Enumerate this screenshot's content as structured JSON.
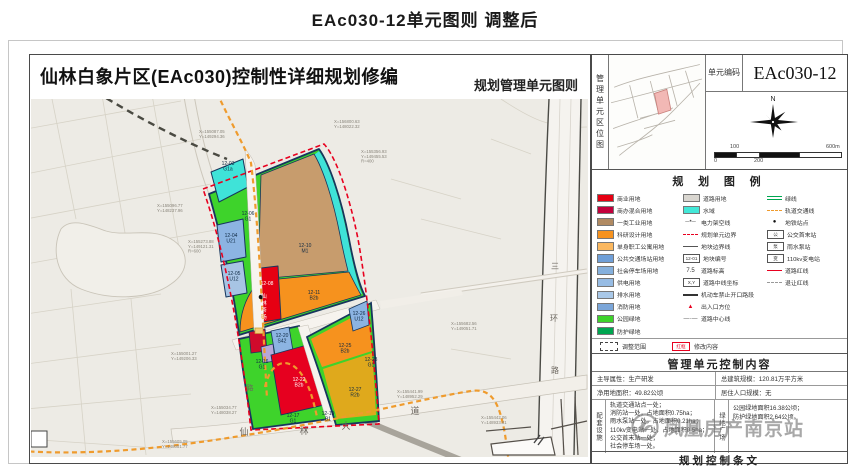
{
  "page": {
    "title": "EAc030-12单元图则 调整后"
  },
  "sheet": {
    "title": "仙林白象片区(EAc030)控制性详细规划修编",
    "subtitle": "规划管理单元图则"
  },
  "unit": {
    "code_label": "单元\n编码",
    "code": "EAc030-12"
  },
  "location": {
    "label": "管理单元区位图"
  },
  "compass": {
    "north": "N"
  },
  "scalebar": {
    "above_1": "100",
    "above_2": "600m",
    "below_1": "0",
    "below_2": "200"
  },
  "legend": {
    "title": "规 划 图 例",
    "cols": [
      [
        {
          "k": "box",
          "c": "#e60012",
          "label": "商业用地"
        },
        {
          "k": "box",
          "c": "#c2003c",
          "label": "商办混合用地"
        },
        {
          "k": "box",
          "c": "#b08a62",
          "label": "一类工业用地"
        },
        {
          "k": "box",
          "c": "#f6921e",
          "label": "科研设计用地"
        },
        {
          "k": "box",
          "c": "#fbb860",
          "label": "单身职工公寓用地"
        },
        {
          "k": "box",
          "c": "#6f9fd8",
          "label": "公共交通场站用地"
        },
        {
          "k": "box",
          "c": "#85b0dd",
          "label": "社会停车场用地"
        },
        {
          "k": "box",
          "c": "#97bce4",
          "label": "供电用地"
        },
        {
          "k": "box",
          "c": "#a9c8e8",
          "label": "排水用地"
        },
        {
          "k": "box",
          "c": "#7ba6d9",
          "label": "消防用地"
        },
        {
          "k": "box",
          "c": "#3ed32b",
          "label": "公园绿地"
        },
        {
          "k": "box",
          "c": "#00a650",
          "label": "防护绿地"
        }
      ],
      [
        {
          "k": "box",
          "c": "#d9d6d0",
          "label": "道路用地"
        },
        {
          "k": "box",
          "c": "#43e8d8",
          "label": "水域"
        },
        {
          "k": "glyph",
          "ch": "─•─",
          "c": "#555",
          "label": "电力架空线"
        },
        {
          "k": "line",
          "style": "dashed",
          "c": "#e8001f",
          "label": "规划单元边界"
        },
        {
          "k": "line",
          "style": "solid",
          "c": "#555",
          "label": "地块边界线"
        },
        {
          "k": "sym",
          "ch": "12-01",
          "label": "地块编号"
        },
        {
          "k": "glyph",
          "ch": "7.5",
          "c": "#333",
          "label": "道路标高"
        },
        {
          "k": "sym",
          "ch": "X,Y",
          "label": "道路中线坐标"
        },
        {
          "k": "line",
          "style": "thick",
          "c": "#333",
          "label": "机动车禁止开口路段"
        },
        {
          "k": "glyph",
          "ch": "▲",
          "c": "#e8001f",
          "label": "出入口方位"
        },
        {
          "k": "glyph",
          "ch": "—·—",
          "c": "#555",
          "label": "道路中心线"
        }
      ],
      [
        {
          "k": "line",
          "style": "double",
          "c": "#00a650",
          "label": "绿线"
        },
        {
          "k": "line",
          "style": "dashed",
          "c": "#ef9b2d",
          "label": "轨道交通线"
        },
        {
          "k": "glyph",
          "ch": "●",
          "c": "#111",
          "label": "地铁站点"
        },
        {
          "k": "sym",
          "ch": "公",
          "label": "公交首末站"
        },
        {
          "k": "sym",
          "ch": "泵",
          "label": "雨水泵站"
        },
        {
          "k": "sym",
          "ch": "变",
          "label": "110kv变电站"
        },
        {
          "k": "line",
          "style": "solid",
          "c": "#e8001f",
          "label": "道路红线"
        },
        {
          "k": "line",
          "style": "dashed",
          "c": "#999",
          "label": "退让红线"
        }
      ]
    ],
    "adjust_range_label": "调整范围",
    "modify_label": "修改内容",
    "modify_mark": "红框"
  },
  "content": {
    "title": "管理单元控制内容",
    "attr_r1c1": "主导属性：生产研发",
    "attr_r1c2": "总建筑规模：120.81万平方米",
    "attr_r2c1": "净用地面积：49.82公顷",
    "attr_r2c2": "居住人口规模：无",
    "facilities_header": "配套设施",
    "facilities_lines": [
      "轨道交通站点一处；",
      "消防站一处，占地面积0.75ha；",
      "雨水泵站一处，占地面积0.21ha；",
      "110kv变电站一处，占地面积0.5ha；",
      "公交首末站一处；",
      "社会停车场一处。"
    ],
    "greens_header": "绿地广场",
    "greens_lines": [
      "公园绿地面积16.38公顷；",
      "防护绿地面积2.64公顷。"
    ]
  },
  "provisions": {
    "title": "规划控制条文"
  },
  "watermark": {
    "text": "凤凰房产南京站"
  },
  "map": {
    "colors": {
      "boundary_red": "#e8001f",
      "green": "#3ed32b",
      "cyan": "#3fe3d8",
      "brown": "#c79c6d",
      "orange": "#f6921e",
      "yellow": "#dfa91c",
      "red": "#e60012",
      "blue": "#8cb4e2",
      "metro_orange": "#ef9b2d"
    },
    "parcel_labels": [
      {
        "x": 197,
        "y": 66,
        "lines": [
          "12-03",
          "G1a"
        ]
      },
      {
        "x": 200,
        "y": 138,
        "lines": [
          "12-04",
          "U21"
        ]
      },
      {
        "x": 203,
        "y": 176,
        "lines": [
          "12-05",
          "U12"
        ]
      },
      {
        "x": 217,
        "y": 116,
        "lines": [
          "12-06",
          "G1"
        ]
      },
      {
        "x": 274,
        "y": 148,
        "lines": [
          "12-10",
          "M1"
        ]
      },
      {
        "x": 283,
        "y": 195,
        "lines": [
          "12-11",
          "B2b"
        ]
      },
      {
        "x": 236,
        "y": 186,
        "lines": [
          "12-08"
        ],
        "c": "#ffffff"
      },
      {
        "x": 251,
        "y": 238,
        "lines": [
          "12-20",
          "S42"
        ]
      },
      {
        "x": 231,
        "y": 264,
        "lines": [
          "12-16",
          "G1"
        ]
      },
      {
        "x": 268,
        "y": 282,
        "lines": [
          "12-22",
          "B2b"
        ],
        "c": "#ffffff"
      },
      {
        "x": 328,
        "y": 216,
        "lines": [
          "12-26",
          "U12"
        ]
      },
      {
        "x": 314,
        "y": 248,
        "lines": [
          "12-25",
          "B2b"
        ]
      },
      {
        "x": 324,
        "y": 292,
        "lines": [
          "12-27",
          "R2b"
        ]
      },
      {
        "x": 340,
        "y": 262,
        "lines": [
          "12-28",
          "G1"
        ]
      },
      {
        "x": 262,
        "y": 318,
        "lines": [
          "12-17",
          "G1"
        ]
      },
      {
        "x": 297,
        "y": 316,
        "lines": [
          "12-19",
          "B1"
        ]
      }
    ],
    "coord_labels": [
      {
        "x": 168,
        "y": 34,
        "lines": [
          "X=155087.05",
          "Y=149294.36"
        ]
      },
      {
        "x": 303,
        "y": 24,
        "lines": [
          "X=156800.63",
          "Y=148022.32"
        ]
      },
      {
        "x": 330,
        "y": 54,
        "lines": [
          "X=155356.93",
          "Y=149455.53",
          "R=400"
        ]
      },
      {
        "x": 126,
        "y": 108,
        "lines": [
          "X=155096.77",
          "Y=148237.96"
        ]
      },
      {
        "x": 157,
        "y": 144,
        "lines": [
          "X=155273.88",
          "Y=149121.31",
          "R=600"
        ]
      },
      {
        "x": 140,
        "y": 256,
        "lines": [
          "X=155001.27",
          "Y=149206.33"
        ]
      },
      {
        "x": 180,
        "y": 310,
        "lines": [
          "X=155034.77",
          "Y=148038.27"
        ]
      },
      {
        "x": 131,
        "y": 344,
        "lines": [
          "X=155605.05",
          "Y=148051.77"
        ]
      },
      {
        "x": 420,
        "y": 226,
        "lines": [
          "X=155682.56",
          "Y=149051.71"
        ]
      },
      {
        "x": 366,
        "y": 294,
        "lines": [
          "X=155441.99",
          "Y=148952.29"
        ]
      },
      {
        "x": 450,
        "y": 320,
        "lines": [
          "X=155442.06",
          "Y=148933.81"
        ]
      }
    ],
    "road_chars": [
      {
        "x": 213,
        "y": 336,
        "ch": "仙",
        "s": 9,
        "c": "#6a655e"
      },
      {
        "x": 273,
        "y": 335,
        "ch": "林",
        "s": 9,
        "c": "#6a655e"
      },
      {
        "x": 315,
        "y": 330,
        "ch": "大",
        "s": 9,
        "c": "#6a655e"
      },
      {
        "x": 384,
        "y": 315,
        "ch": "道",
        "s": 9,
        "c": "#6a655e"
      },
      {
        "x": 524,
        "y": 170,
        "ch": "三",
        "s": 8,
        "c": "#6a655e"
      },
      {
        "x": 523,
        "y": 222,
        "ch": "环",
        "s": 8,
        "c": "#6a655e"
      },
      {
        "x": 524,
        "y": 274,
        "ch": "路",
        "s": 8,
        "c": "#6a655e"
      },
      {
        "x": 219,
        "y": 291,
        "ch": "路",
        "s": 7,
        "c": "#6a655e"
      },
      {
        "x": 233,
        "y": 199,
        "ch": "仙",
        "s": 5.5,
        "c": "#ffffff"
      },
      {
        "x": 233,
        "y": 206,
        "ch": "林",
        "s": 5.5,
        "c": "#ffffff"
      },
      {
        "x": 233,
        "y": 213,
        "ch": "茶",
        "s": 5.5,
        "c": "#ffffff"
      },
      {
        "x": 233,
        "y": 220,
        "ch": "场",
        "s": 5.5,
        "c": "#ffffff"
      }
    ]
  }
}
